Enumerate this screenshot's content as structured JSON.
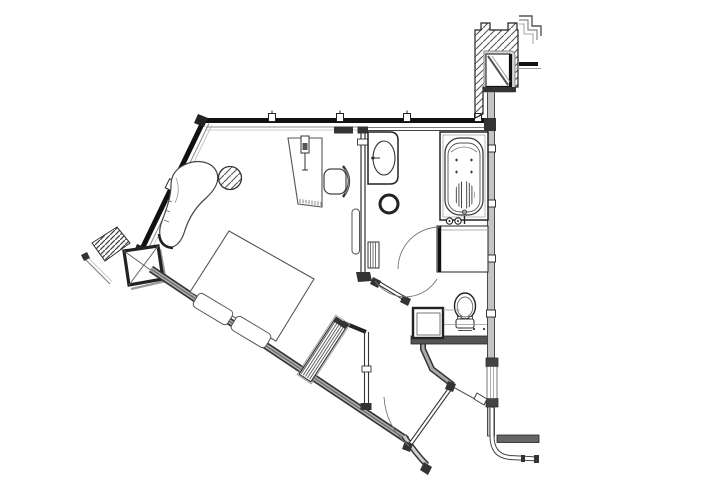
{
  "drawing": {
    "kind": "architectural floor plan",
    "rooms": [
      "bedroom",
      "bathroom",
      "entry-vestibule"
    ],
    "fixtures": [
      "bed",
      "pillow-left",
      "pillow-right",
      "chaise-lounge",
      "side-table",
      "desk",
      "desk-lamp",
      "desk-chair",
      "louver-luggage-rack",
      "sink-vanity",
      "stool",
      "towel-radiator",
      "bathtub",
      "bath-mat",
      "tub-faucet",
      "closet",
      "toilet",
      "minibar-cabinet",
      "entry-door",
      "bathroom-door",
      "closet-door",
      "window-wall-top",
      "window-wall-left",
      "corner-column-left",
      "structural-column-top-right",
      "shaft-window-detail",
      "right-exterior-wall",
      "balcony-door-frame",
      "stepped-detail-lines"
    ],
    "scale_text": "",
    "annotations": ""
  },
  "colors": {
    "ink": "#1c1c1c",
    "mid": "#555555",
    "soft": "#8c8c8c",
    "faint": "#aaaaaa",
    "wall": "#9a9a9a",
    "lightwall": "#c4c4c4",
    "paper": "#ffffff"
  }
}
